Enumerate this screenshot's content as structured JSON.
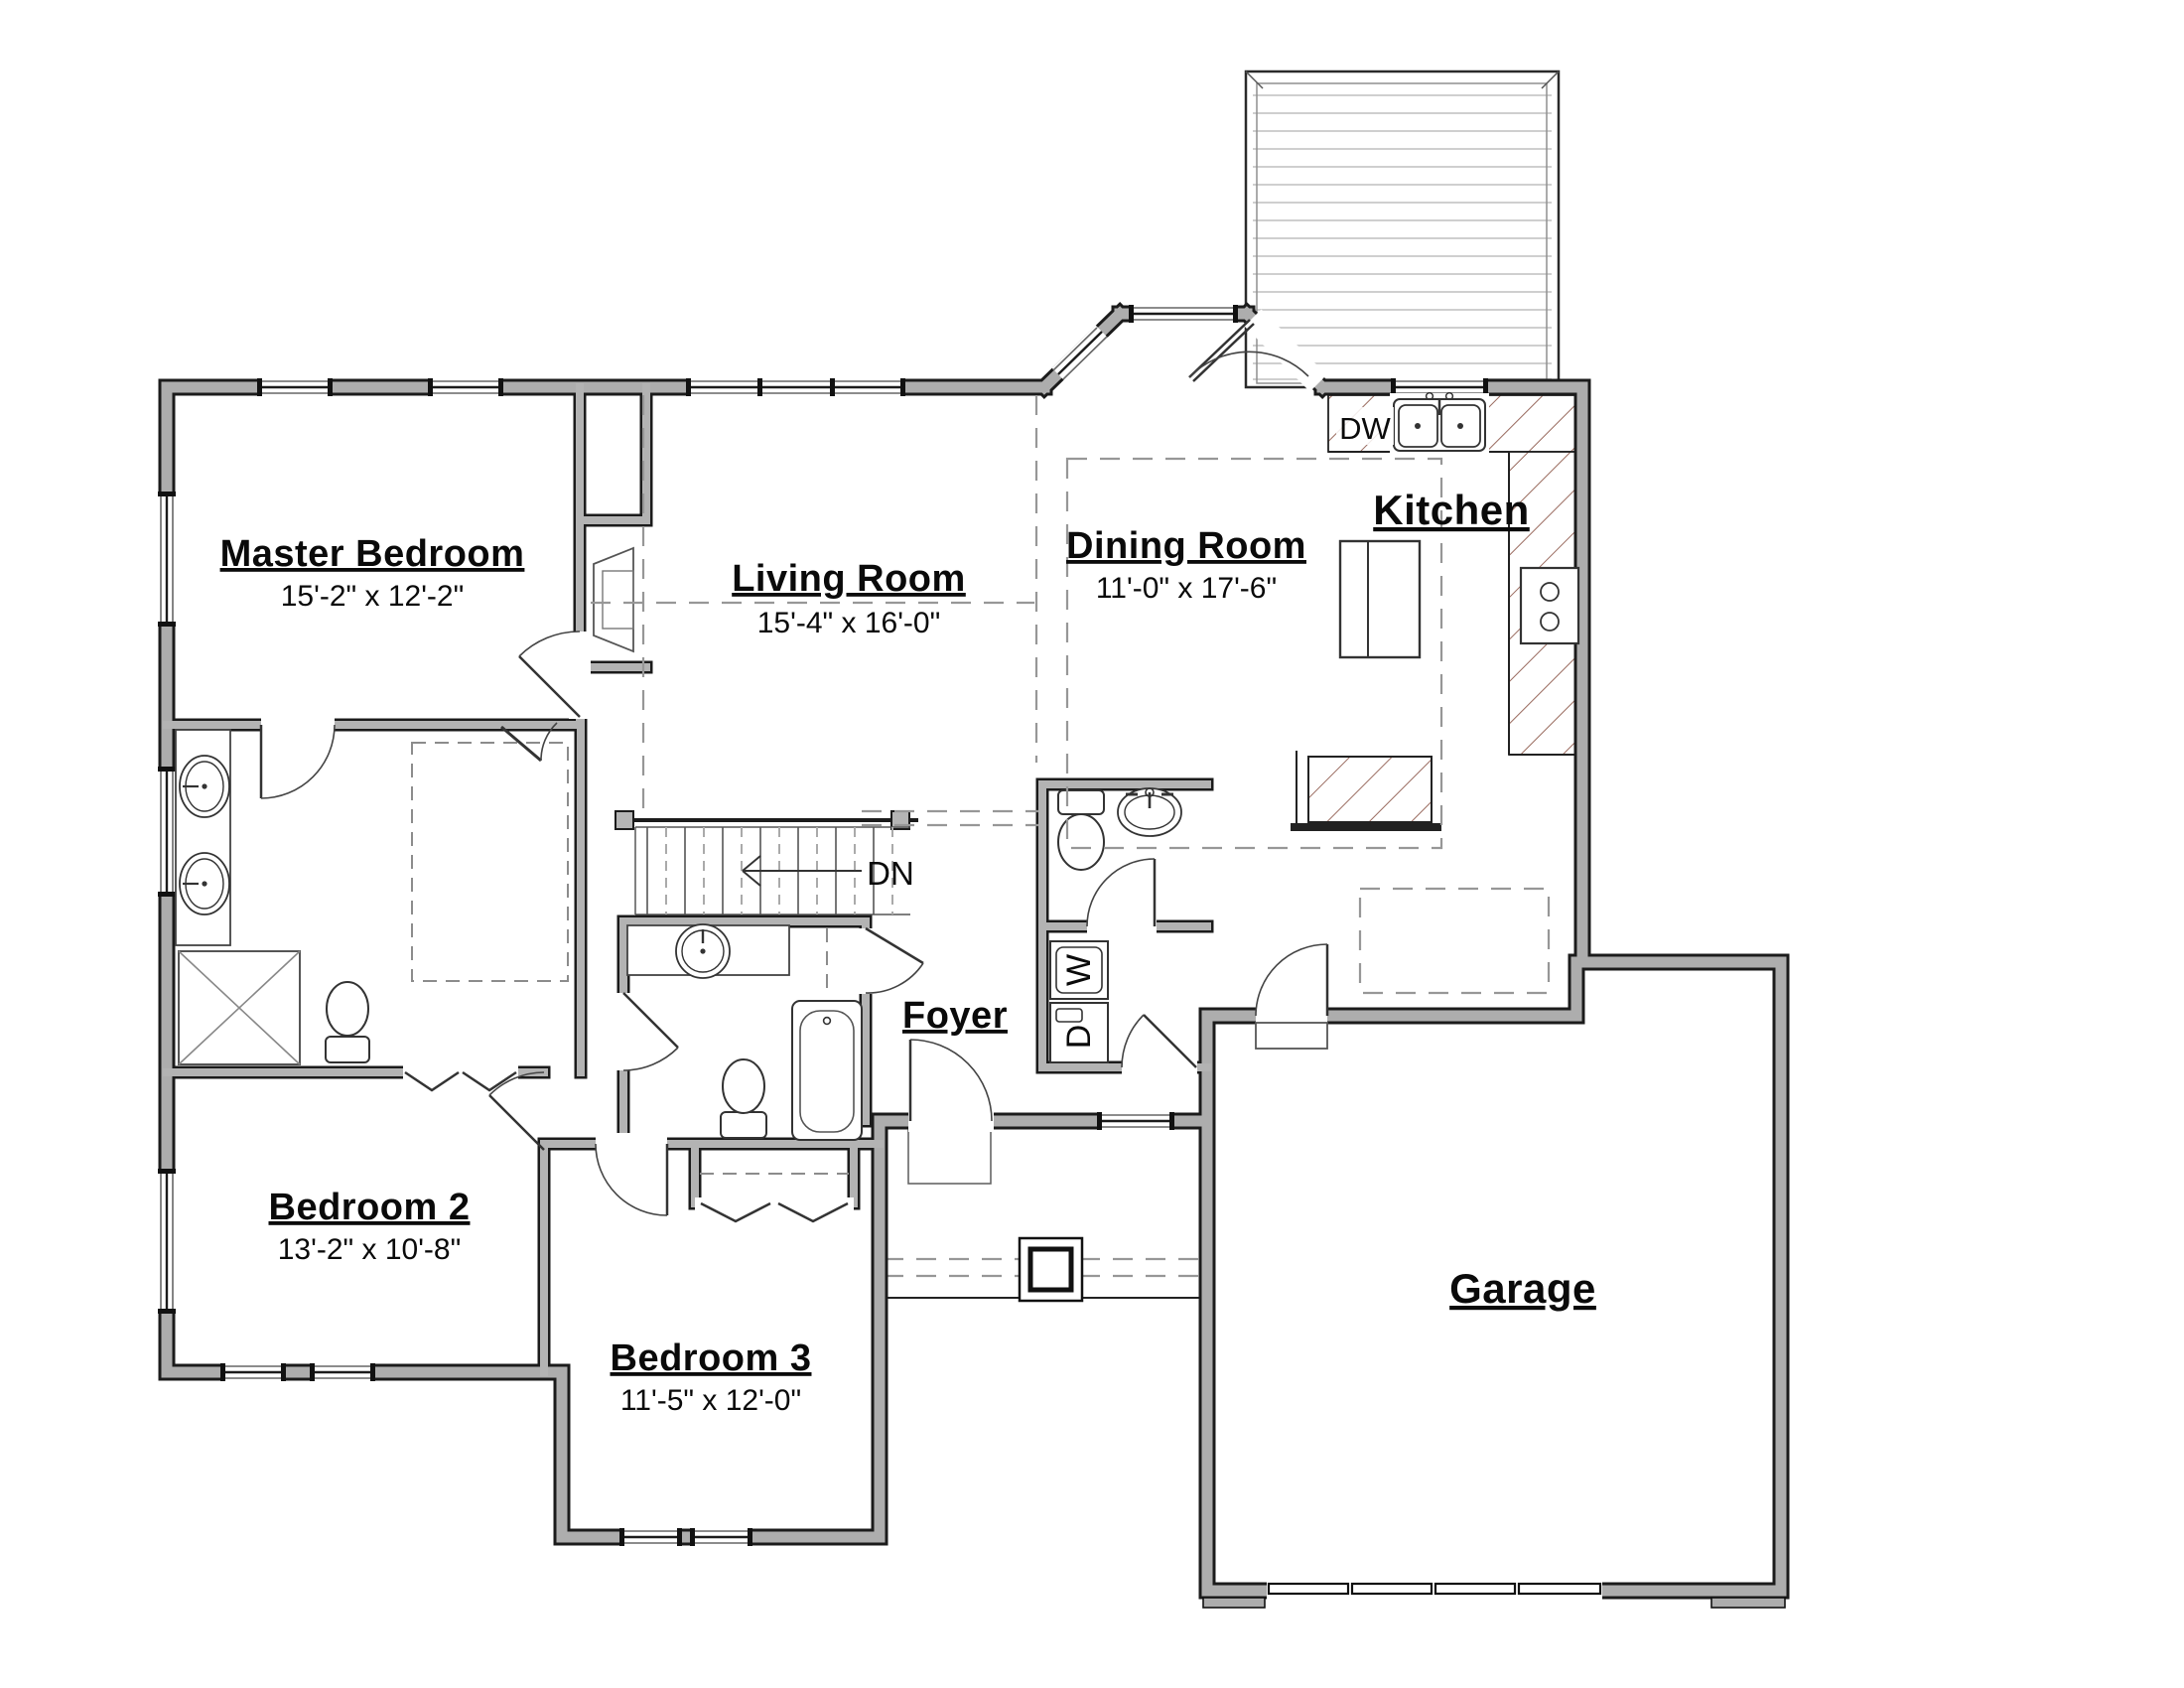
{
  "document": {
    "type": "floor-plan",
    "floor": "main level"
  },
  "rooms": {
    "master_bedroom": {
      "name": "Master Bedroom",
      "dims": "15'-2\" x 12'-2\""
    },
    "living_room": {
      "name": "Living Room",
      "dims": "15'-4\" x 16'-0\""
    },
    "dining_room": {
      "name": "Dining Room",
      "dims": "11'-0\" x 17'-6\""
    },
    "kitchen": {
      "name": "Kitchen"
    },
    "foyer": {
      "name": "Foyer"
    },
    "bedroom_2": {
      "name": "Bedroom 2",
      "dims": "13'-2\" x 10'-8\""
    },
    "bedroom_3": {
      "name": "Bedroom 3",
      "dims": "11'-5\" x 12'-0\""
    },
    "garage": {
      "name": "Garage"
    }
  },
  "annotations": {
    "dishwasher": "DW",
    "stairs_down": "DN",
    "washer": "W",
    "dryer": "D"
  },
  "colors": {
    "background": "#ffffff",
    "wall_fill": "#adadad",
    "wall_edge": "#1b1b1b",
    "counter_hatch": "#9a6b5f",
    "deck_planks": "#cfcfcf",
    "dashed_lines": "#979797",
    "text": "#0a0a0a"
  }
}
